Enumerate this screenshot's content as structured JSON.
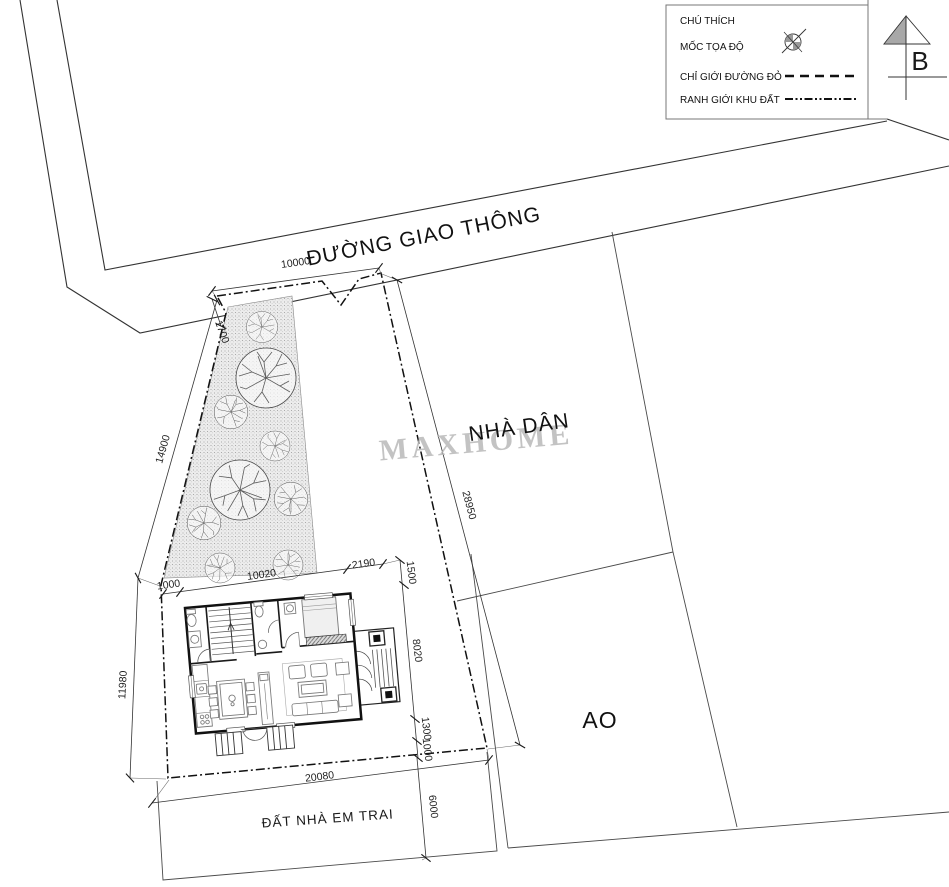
{
  "legend": {
    "title": "CHÚ THÍCH",
    "items": [
      {
        "label": "MỐC TỌA ĐỘ",
        "symbol": "survey-marker"
      },
      {
        "label": "CHỈ GIỚI ĐƯỜNG ĐỎ",
        "symbol": "dashed-line"
      },
      {
        "label": "RANH GIỚI KHU ĐẤT",
        "symbol": "dash-dot-line"
      }
    ]
  },
  "north_arrow": {
    "label": "B"
  },
  "labels": {
    "road": "ĐƯỜNG GIAO THÔNG",
    "neighbor_house": "NHÀ DÂN",
    "pond": "AO",
    "south_parcel": "ĐẤT NHÀ EM TRAI"
  },
  "watermark": "MAXHOME",
  "dimensions": {
    "road_frontage": "10000",
    "frontage_left": "1700",
    "boundary_left_upper": "14900",
    "boundary_left_lower": "11980",
    "house_left_offset": "1000",
    "house_width": "10020",
    "house_right_offset": "2190",
    "right_chain_top": "1500",
    "house_depth": "8020",
    "right_chain_lower": "1300",
    "right_chain_bottom": "1000",
    "neighbor_boundary": "28950",
    "site_bottom_width": "20080",
    "south_parcel_depth": "6000"
  },
  "colors": {
    "paper": "#ffffff",
    "ink": "#1a1a1a",
    "thin_line": "#555555",
    "garden_fill": "#ececec",
    "watermark": "#b9b9b9",
    "shade": "#a8a8a8"
  }
}
